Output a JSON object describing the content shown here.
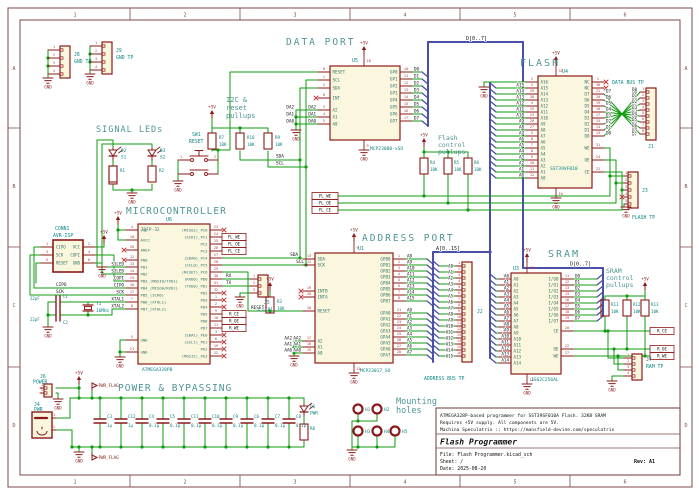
{
  "colors": {
    "wire": "#0f9a0f",
    "bus": "#4a50a8",
    "outline": "#8c1a1a",
    "body_fill": "#fbf7df",
    "pin_number": "#c03535",
    "pin_name": "#2f7368",
    "ref": "#0f8585",
    "section_title": "#4f9494",
    "net_label": "#111111",
    "power": "#8c1a1a",
    "frame": "#7d4a4a",
    "paper": "#ffffff"
  },
  "frame": {
    "cols": [
      "1",
      "2",
      "3",
      "4",
      "5",
      "6"
    ],
    "rows": [
      "A",
      "B",
      "C",
      "D"
    ]
  },
  "title_block": {
    "comment1": "ATMEGA328P-based programmer for SST39SF010A Flash. 32KB SRAM",
    "comment2": "Requires +5V supply. All components are 5V.",
    "comment3": "Machina Speculatrix :: https://mansfield-devine.com/speculatrix",
    "title": "Flash Programmer",
    "file": "File: Flash Programmer.kicad_sch",
    "sheet": "Sheet: /",
    "date": "Date: 2025-08-20",
    "rev": "Rev: A1"
  },
  "titles": {
    "signal_leds": "SIGNAL LEDs",
    "i2c_pullups": [
      "I2C &",
      "reset",
      "pullups"
    ],
    "data_port": "DATA PORT",
    "flash": "FLASH",
    "flash_pullups": [
      "Flash",
      "control",
      "pullups"
    ],
    "micro": "MICROCONTROLLER",
    "address_port": "ADDRESS PORT",
    "sram": "SRAM",
    "sram_pullups": [
      "SRAM",
      "control",
      "pullups"
    ],
    "power": "POWER & BYPASSING",
    "mounting": [
      "Mounting",
      "holes"
    ]
  },
  "power_symbols": {
    "p5v": "+5V",
    "gnd": "GND",
    "pwr_flag": "PWR_FLAG"
  },
  "bus_labels": {
    "data": "D[0..7]",
    "addr": "A[0..15]"
  },
  "data_bits": [
    "D0",
    "D1",
    "D2",
    "D3",
    "D4",
    "D5",
    "D6",
    "D7"
  ],
  "addr_bits": [
    "A0",
    "A1",
    "A2",
    "A3",
    "A4",
    "A5",
    "A6",
    "A7",
    "A8",
    "A9",
    "A10",
    "A11",
    "A12",
    "A13",
    "A14",
    "A15"
  ],
  "net_labels": {
    "sda": "SDA",
    "scl": "SCL",
    "rx": "RX",
    "tx": "TX",
    "reset": "RESET",
    "cipo": "CIPO",
    "copi": "COPI",
    "sck": "SCK",
    "da": [
      "DA2",
      "DA1",
      "DA0"
    ],
    "aa": [
      "AA2",
      "AA1",
      "AA0"
    ]
  },
  "global_labels": {
    "fl": [
      "FL_WE",
      "FL_OE",
      "FL_CE"
    ],
    "ram": [
      "R_CE",
      "R_OE",
      "R_WE"
    ]
  },
  "ics": {
    "U5": {
      "ref": "U5",
      "value": "MCP23008-xSO",
      "left": [
        {
          "n": "6",
          "name": "RESET"
        },
        {
          "n": "1",
          "name": "SCL"
        },
        {
          "n": "2",
          "name": "SDA"
        },
        {
          "n": "8",
          "name": "INT",
          "nc": true
        },
        {
          "n": "3",
          "name": "A2",
          "label": "DA2"
        },
        {
          "n": "4",
          "name": "A1",
          "label": "DA1"
        },
        {
          "n": "5",
          "name": "A0",
          "label": "DA0"
        }
      ],
      "right": [
        {
          "n": "10",
          "name": "GP0",
          "label": "D0"
        },
        {
          "n": "11",
          "name": "GP1",
          "label": "D1"
        },
        {
          "n": "12",
          "name": "GP2",
          "label": "D2"
        },
        {
          "n": "13",
          "name": "GP3",
          "label": "D3"
        },
        {
          "n": "14",
          "name": "GP4",
          "label": "D4"
        },
        {
          "n": "15",
          "name": "GP5",
          "label": "D5"
        },
        {
          "n": "16",
          "name": "GP6",
          "label": "D6"
        },
        {
          "n": "17",
          "name": "GP7",
          "label": "D7"
        }
      ],
      "top": "18",
      "bottom": "9"
    },
    "U1": {
      "ref": "U1",
      "value": "MCP23017_SO",
      "left": [
        {
          "n": "13",
          "name": "SDA"
        },
        {
          "n": "12",
          "name": "SCK"
        },
        {
          "n": "19",
          "name": "INTB",
          "nc": true
        },
        {
          "n": "20",
          "name": "INTA",
          "nc": true
        },
        {
          "n": "18",
          "name": "RESET"
        },
        {
          "n": "17",
          "name": "A2",
          "label": "AA2"
        },
        {
          "n": "16",
          "name": "A1",
          "label": "AA1"
        },
        {
          "n": "15",
          "name": "A0",
          "label": "AA0"
        }
      ],
      "right": [
        {
          "n": "1",
          "name": "GPB0",
          "label": "A8"
        },
        {
          "n": "2",
          "name": "GPB1",
          "label": "A9"
        },
        {
          "n": "3",
          "name": "GPB2",
          "label": "A10"
        },
        {
          "n": "4",
          "name": "GPB3",
          "label": "A11"
        },
        {
          "n": "5",
          "name": "GPB4",
          "label": "A12"
        },
        {
          "n": "6",
          "name": "GPB5",
          "label": "A13"
        },
        {
          "n": "7",
          "name": "GPB6",
          "label": "A14"
        },
        {
          "n": "8",
          "name": "GPB7",
          "label": "A15"
        },
        {
          "n": "21",
          "name": "GPA0",
          "label": "A0"
        },
        {
          "n": "22",
          "name": "GPA1",
          "label": "A1"
        },
        {
          "n": "23",
          "name": "GPA2",
          "label": "A2"
        },
        {
          "n": "24",
          "name": "GPA3",
          "label": "A3"
        },
        {
          "n": "25",
          "name": "GPA4",
          "label": "A4"
        },
        {
          "n": "26",
          "name": "GPA5",
          "label": "A5"
        },
        {
          "n": "27",
          "name": "GPA6",
          "label": "A6"
        },
        {
          "n": "28",
          "name": "GPA7",
          "label": "A7"
        }
      ],
      "top": "9",
      "bottom": "10"
    },
    "U6": {
      "ref": "U6",
      "value": "ATMEGA328PB",
      "package": "TQFP-32",
      "left": [
        {
          "n": "4",
          "name": "VCC"
        },
        {
          "n": "18",
          "name": "AVCC"
        },
        {
          "n": "20",
          "name": "AREF",
          "nc": true
        },
        {
          "n": "12",
          "name": "PB0",
          "nc": true
        },
        {
          "n": "13",
          "name": "PB1",
          "label": "S1LED"
        },
        {
          "n": "14",
          "name": "PB2",
          "label": "S2LED"
        },
        {
          "n": "15",
          "name": "PB3_(MOSI0/TXD1)",
          "label": "COPI"
        },
        {
          "n": "16",
          "name": "PB4_(MISO0/RXD1)",
          "label": "CIPO"
        },
        {
          "n": "17",
          "name": "PB5_(SCK0)",
          "label": "SCK"
        },
        {
          "n": "7",
          "name": "PB6_(XTAL1)",
          "label": "XTAL1"
        },
        {
          "n": "8",
          "name": "PB7_(XTAL2)",
          "label": "XTAL2"
        },
        {
          "n": "5",
          "name": "GND"
        },
        {
          "n": "21",
          "name": "GND"
        }
      ],
      "right": [
        {
          "n": "23",
          "name": "(MISO1)_PC0",
          "nc": true
        },
        {
          "n": "24",
          "name": "(SCK1)_PC1"
        },
        {
          "n": "25",
          "name": "PC2"
        },
        {
          "n": "26",
          "name": "PC3"
        },
        {
          "n": "27",
          "name": "(SDA0)_PC4"
        },
        {
          "n": "28",
          "name": "(SCL0)_PC5"
        },
        {
          "n": "29",
          "name": "(RESET)_PC6"
        },
        {
          "n": "30",
          "name": "(RXD0)_PD0"
        },
        {
          "n": "31",
          "name": "(TXD0)_PD1"
        },
        {
          "n": "32",
          "name": "PD2",
          "nc": true
        },
        {
          "n": "1",
          "name": "PD3",
          "nc": true
        },
        {
          "n": "2",
          "name": "PD4",
          "nc": true
        },
        {
          "n": "9",
          "name": "PD5"
        },
        {
          "n": "10",
          "name": "PD6"
        },
        {
          "n": "11",
          "name": "PD7"
        },
        {
          "n": "3",
          "name": "(SDA1)_PE0",
          "nc": true
        },
        {
          "n": "6",
          "name": "(SCL1)_PE1",
          "nc": true
        },
        {
          "n": "19",
          "name": "PE2",
          "nc": true
        },
        {
          "n": "22",
          "name": "(MOSI1)_PE3",
          "nc": true
        }
      ]
    },
    "U4": {
      "ref": "U4",
      "value": "SST39VF010",
      "left": [
        {
          "n": "2",
          "name": "A16"
        },
        {
          "n": "3",
          "name": "A15",
          "label": "A15"
        },
        {
          "n": "29",
          "name": "A14",
          "label": "A14"
        },
        {
          "n": "28",
          "name": "A13",
          "label": "A13"
        },
        {
          "n": "4",
          "name": "A12",
          "label": "A12"
        },
        {
          "n": "25",
          "name": "A11",
          "label": "A11"
        },
        {
          "n": "23",
          "name": "A10",
          "label": "A10"
        },
        {
          "n": "26",
          "name": "A9",
          "label": "A9"
        },
        {
          "n": "27",
          "name": "A8",
          "label": "A8"
        },
        {
          "n": "5",
          "name": "A7",
          "label": "A7"
        },
        {
          "n": "6",
          "name": "A6",
          "label": "A6"
        },
        {
          "n": "7",
          "name": "A5",
          "label": "A5"
        },
        {
          "n": "8",
          "name": "A4",
          "label": "A4"
        },
        {
          "n": "9",
          "name": "A3",
          "label": "A3"
        },
        {
          "n": "10",
          "name": "A2",
          "label": "A2"
        },
        {
          "n": "11",
          "name": "A1",
          "label": "A1"
        },
        {
          "n": "12",
          "name": "A0",
          "label": "A0"
        }
      ],
      "right": [
        {
          "n": "1",
          "name": "NC",
          "nc": true
        },
        {
          "n": "30",
          "name": "NC",
          "nc": true
        },
        {
          "n": "21",
          "name": "D7",
          "label": "D7"
        },
        {
          "n": "20",
          "name": "D6",
          "label": "D6"
        },
        {
          "n": "19",
          "name": "D5",
          "label": "D5"
        },
        {
          "n": "18",
          "name": "D4",
          "label": "D4"
        },
        {
          "n": "17",
          "name": "D3",
          "label": "D3"
        },
        {
          "n": "15",
          "name": "D2",
          "label": "D2"
        },
        {
          "n": "14",
          "name": "D1",
          "label": "D1"
        },
        {
          "n": "13",
          "name": "D0",
          "label": "D0"
        },
        {
          "n": "31",
          "name": "WE"
        },
        {
          "n": "24",
          "name": "OE"
        },
        {
          "n": "22",
          "name": "CE"
        }
      ],
      "top": "32",
      "bottom": "16"
    },
    "U3": {
      "ref": "U3",
      "value": "IS62C256AL",
      "left": [
        {
          "n": "10",
          "name": "A0",
          "label": "A0"
        },
        {
          "n": "9",
          "name": "A1",
          "label": "A1"
        },
        {
          "n": "8",
          "name": "A2",
          "label": "A2"
        },
        {
          "n": "7",
          "name": "A3",
          "label": "A3"
        },
        {
          "n": "6",
          "name": "A4",
          "label": "A4"
        },
        {
          "n": "5",
          "name": "A5",
          "label": "A5"
        },
        {
          "n": "4",
          "name": "A6",
          "label": "A6"
        },
        {
          "n": "3",
          "name": "A7",
          "label": "A7"
        },
        {
          "n": "25",
          "name": "A8",
          "label": "A8"
        },
        {
          "n": "24",
          "name": "A9",
          "label": "A9"
        },
        {
          "n": "21",
          "name": "A10",
          "label": "A10"
        },
        {
          "n": "23",
          "name": "A11",
          "label": "A11"
        },
        {
          "n": "2",
          "name": "A12",
          "label": "A12"
        },
        {
          "n": "26",
          "name": "A13",
          "label": "A13"
        },
        {
          "n": "1",
          "name": "A14",
          "label": "A14"
        }
      ],
      "right": [
        {
          "n": "11",
          "name": "I/O0",
          "label": "D0"
        },
        {
          "n": "12",
          "name": "I/O1",
          "label": "D1"
        },
        {
          "n": "13",
          "name": "I/O2",
          "label": "D2"
        },
        {
          "n": "15",
          "name": "I/O3",
          "label": "D3"
        },
        {
          "n": "16",
          "name": "I/O4",
          "label": "D4"
        },
        {
          "n": "17",
          "name": "I/O5",
          "label": "D5"
        },
        {
          "n": "18",
          "name": "I/O6",
          "label": "D6"
        },
        {
          "n": "19",
          "name": "I/O7",
          "label": "D7"
        },
        {
          "n": "20",
          "name": "CE"
        },
        {
          "n": "22",
          "name": "OE"
        },
        {
          "n": "27",
          "name": "WE"
        }
      ],
      "top": "28",
      "bottom": "14"
    }
  },
  "connectors": {
    "J8": {
      "ref": "J8",
      "value": "GND TP",
      "pins": [
        "1",
        "2",
        "3",
        "4"
      ]
    },
    "J9": {
      "ref": "J9",
      "value": "GND TP",
      "pins": [
        "1",
        "2",
        "3",
        "4"
      ]
    },
    "J1": {
      "ref": "J1",
      "value": "DATA BUS TP",
      "pins": [
        "1",
        "2",
        "3",
        "4",
        "5",
        "6",
        "7",
        "8"
      ]
    },
    "J2": {
      "ref": "J2",
      "value": "ADDRESS BUS TP",
      "pins": [
        "1",
        "2",
        "3",
        "4",
        "5",
        "6",
        "7",
        "8",
        "9",
        "10",
        "11",
        "12",
        "13",
        "14",
        "15",
        "16"
      ]
    },
    "J3": {
      "ref": "J3",
      "value": "FLASH TP",
      "pins": [
        "1",
        "2",
        "3",
        "4",
        "5"
      ]
    },
    "J5": {
      "ref": "J5",
      "value": "SERIAL",
      "pins": [
        "1",
        "2",
        "3"
      ]
    },
    "J6": {
      "ref": "J6",
      "value": "POWER",
      "pins": [
        "1",
        "2"
      ]
    },
    "J7": {
      "ref": "J7",
      "value": "RAM TP",
      "pins": [
        "1",
        "2",
        "3",
        "4"
      ]
    },
    "J4": {
      "ref": "J4",
      "value": "PWR",
      "pins": [
        "1",
        "2"
      ]
    },
    "CONN1": {
      "ref": "CONN1",
      "value": "AVR-ISP",
      "rows": [
        [
          "CIPO",
          "1",
          "VCC",
          "2"
        ],
        [
          "SCK",
          "3",
          "COPI",
          "4"
        ],
        [
          "RESET",
          "5",
          "GND",
          "6"
        ]
      ]
    }
  },
  "resistors": {
    "R1": {
      "ref": "R1",
      "value": ""
    },
    "R2": {
      "ref": "R2",
      "value": ""
    },
    "R3": {
      "ref": "R3",
      "value": "10K"
    },
    "R4": {
      "ref": "R4",
      "value": "10K"
    },
    "R5": {
      "ref": "R5",
      "value": "10K"
    },
    "R6": {
      "ref": "R6",
      "value": "10K"
    },
    "R7": {
      "ref": "R7",
      "value": "10K"
    },
    "R9": {
      "ref": "R9",
      "value": "10K"
    },
    "R10": {
      "ref": "R10",
      "value": "10K"
    },
    "R11": {
      "ref": "R11",
      "value": "10K"
    },
    "R12": {
      "ref": "R12",
      "value": "10K"
    },
    "R13": {
      "ref": "R13",
      "value": "10K"
    },
    "R8": {
      "ref": "R8",
      "value": ""
    }
  },
  "capacitors": {
    "bypass": [
      {
        "ref": "C3",
        "value": "1µ"
      },
      {
        "ref": "C12",
        "value": "1µ"
      },
      {
        "ref": "C4",
        "value": "0.1µ"
      },
      {
        "ref": "C5",
        "value": "0.1µ"
      },
      {
        "ref": "C11",
        "value": "0.1µ"
      },
      {
        "ref": "C10",
        "value": "0.1µ"
      },
      {
        "ref": "C9",
        "value": "0.1µ"
      },
      {
        "ref": "C6",
        "value": "0.1µ"
      },
      {
        "ref": "C7",
        "value": "0.1µ"
      },
      {
        "ref": "C8",
        "value": "0.1µ"
      }
    ],
    "xtal": [
      {
        "ref": "C1",
        "value": "22pF"
      },
      {
        "ref": "C2",
        "value": "22pF"
      }
    ]
  },
  "leds": {
    "D1": {
      "ref": "D1",
      "value": "PWR"
    },
    "D2": {
      "ref": "D2",
      "value": "S1"
    },
    "D3": {
      "ref": "D3",
      "value": "S2"
    }
  },
  "crystal": {
    "ref": "Y1",
    "value": "16MHz"
  },
  "switch": {
    "ref": "SW1",
    "value": "RESET"
  },
  "holes": [
    "H1",
    "H2",
    "H3",
    "H4",
    "H5"
  ]
}
